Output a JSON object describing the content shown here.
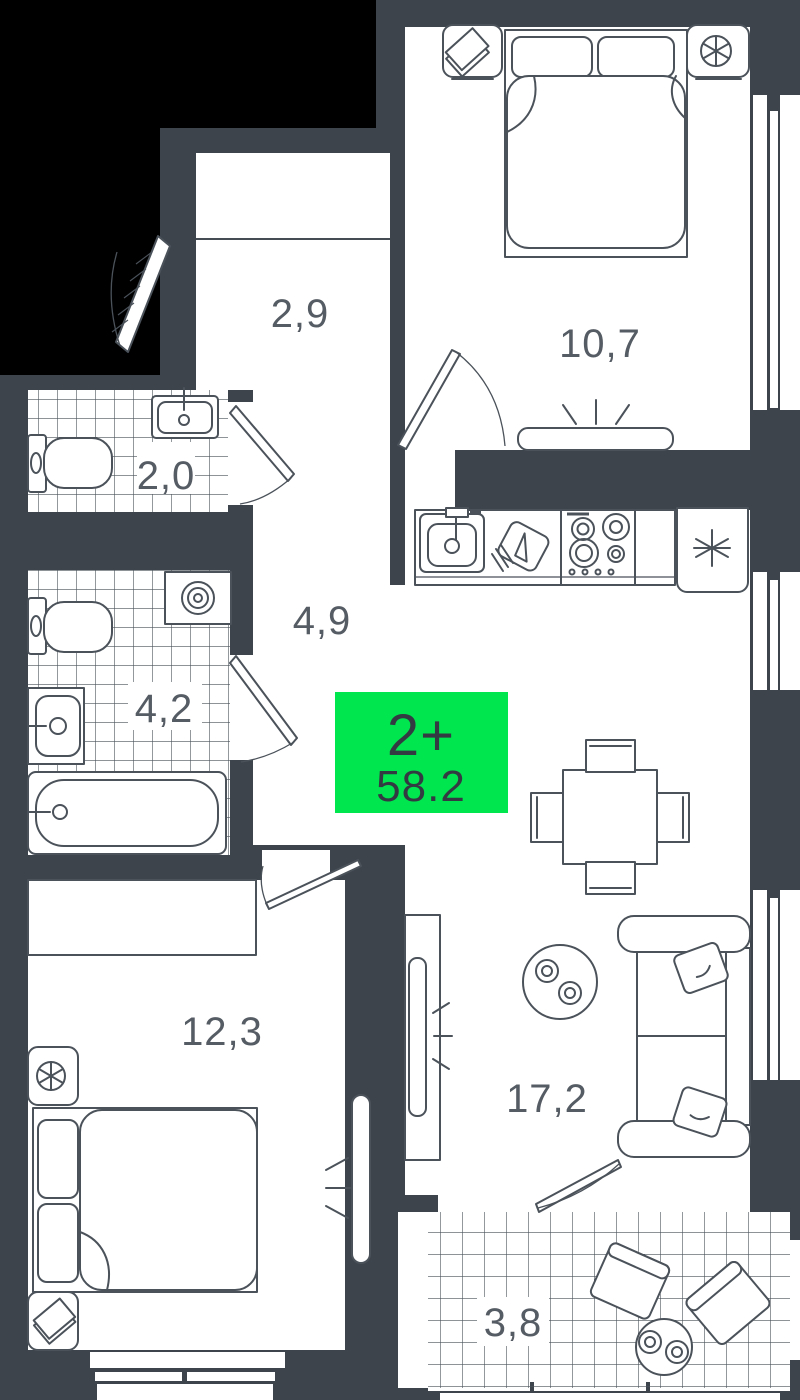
{
  "plan": {
    "badge": {
      "rooms_label": "2+",
      "total_area": "58.2",
      "color": "#00e64f"
    },
    "rooms": [
      {
        "id": "entry-hall",
        "area_label": "2,9"
      },
      {
        "id": "bedroom-top",
        "area_label": "10,7"
      },
      {
        "id": "wc",
        "area_label": "2,0"
      },
      {
        "id": "hallway",
        "area_label": "4,9"
      },
      {
        "id": "bathroom",
        "area_label": "4,2"
      },
      {
        "id": "bedroom-bottom",
        "area_label": "12,3"
      },
      {
        "id": "living-kitchen",
        "area_label": "17,2"
      },
      {
        "id": "balcony",
        "area_label": "3,8"
      }
    ],
    "colors": {
      "background": "#000000",
      "wall": "#3d444c",
      "room_fill": "#ffffff",
      "furniture_line": "#4b525a",
      "label_text": "#565c64",
      "badge_green": "#00e64f",
      "badge_text": "#333a42"
    },
    "icons": {
      "fridge": "snowflake-asterisk",
      "washing_machine": "spiral",
      "ventilation": "fan-circle",
      "books": "stacked-diamond"
    }
  }
}
